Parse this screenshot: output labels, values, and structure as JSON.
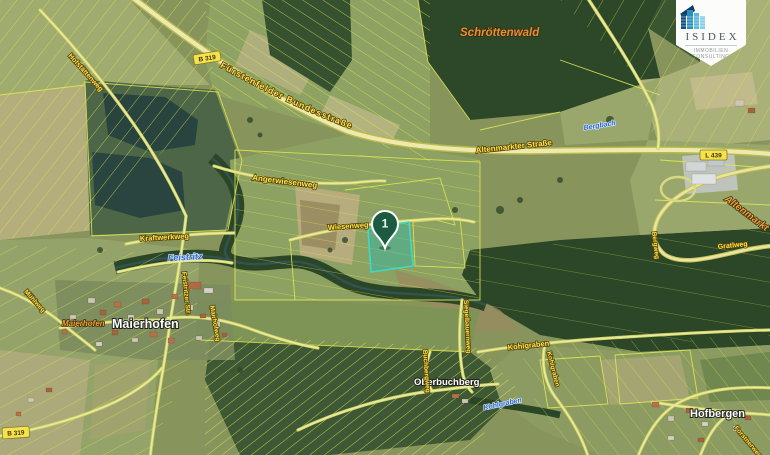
{
  "logo": {
    "name": "ISIDEX",
    "tagline": "IMMOBILIEN CONSULTING"
  },
  "marker": {
    "number": "1"
  },
  "map": {
    "badges": {
      "b_top": "B 319",
      "l_right": "L 439",
      "b_bottom": "B 319"
    },
    "labels": {
      "hofstaettenweg": "Hofstättenweg",
      "bundesstrasse": "Fürstenfelder Bundesstraße",
      "schroettenwald": "Schröttenwald",
      "bergbach": "Bergbach",
      "altenmarkter_strasse": "Altenmarkter Straße",
      "altenmarkt": "Altenmarkt",
      "gratlweg": "Gratlweg",
      "bergweg": "Bergweg",
      "angerwiesenweg": "Angerwiesenweg",
      "wiesenweg": "Wiesenweg",
      "kraftwerkweg": "Kraftwerkweg",
      "feistritz": "Feistritz",
      "feistritzer_str": "Feistritzer Str.",
      "maierhofen_klein": "Maierhofen",
      "maierhofen": "Maierhofen",
      "mairhofweg": "Mairhofweg",
      "muehlweg": "Mühlweg",
      "oberbuchberg": "Oberbuchberg",
      "buchbergweg": "Buchbergweg",
      "kohlgraben_road": "Kohlgraben",
      "kohlgraben_road2": "Kohlgraben",
      "kohlgraben_bach": "Kohlgraben",
      "hofbergen": "Hofbergen",
      "forstnerweg": "Forstnerweg",
      "siegelbauernweg": "Siegelbauernweg"
    },
    "colors": {
      "parcel_line": "#e0e94f",
      "highlight_fill": "#2db9aa",
      "highlight_stroke": "#3fd9c6",
      "marker_green": "#1c5b41",
      "place_orange": "#eda13f",
      "road_label_yellow": "#ffe44d",
      "water_label_blue": "#2f66cc"
    }
  }
}
